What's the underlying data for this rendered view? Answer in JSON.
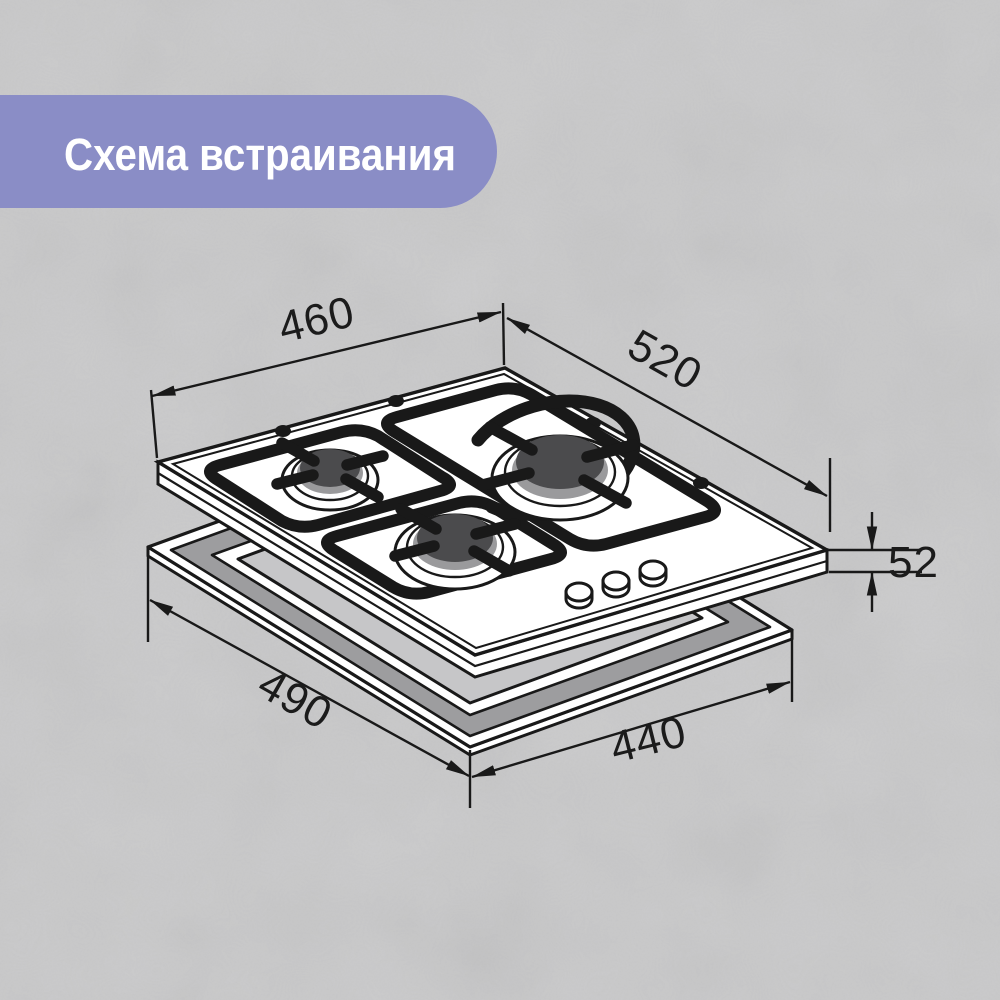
{
  "title": "Схема встраивания",
  "diagram": {
    "dim_hob_width": "460",
    "dim_hob_depth": "520",
    "dim_built_in_height": "52",
    "dim_cutout_depth": "490",
    "dim_cutout_width": "440",
    "burner_count": 3,
    "knob_count": 3
  },
  "colors": {
    "background": "#c9c9ca",
    "banner": "#8a8dc6",
    "title_text": "#ffffff",
    "line": "#191919",
    "burner_cap": "#4b4b4d",
    "burner_ring": "#9a9a9c",
    "frame_wall": "#9d9d9f",
    "opening": "#c6c6c8"
  }
}
